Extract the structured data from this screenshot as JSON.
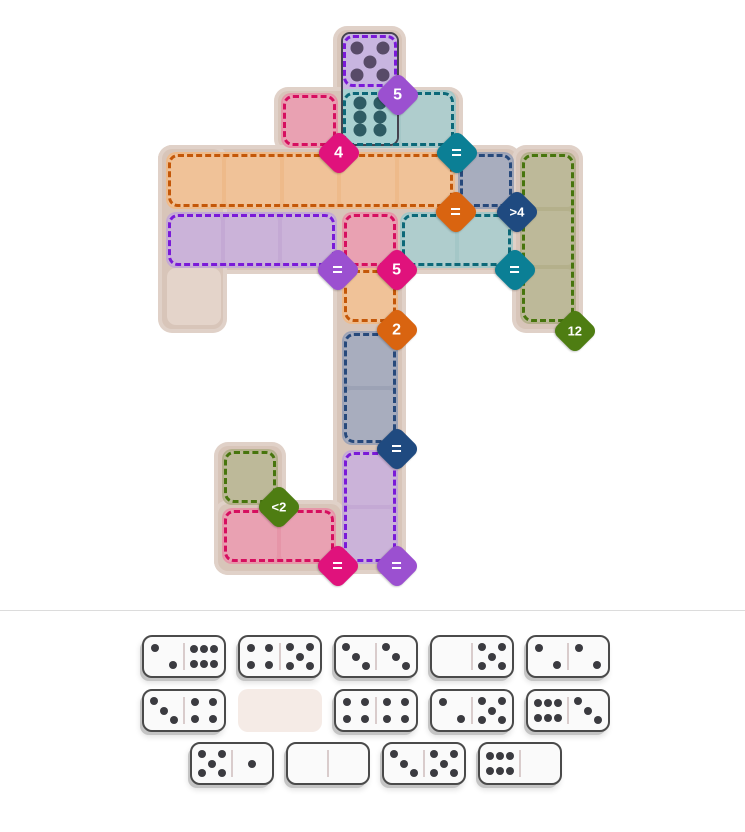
{
  "title": "domino-pips-puzzle",
  "palette": {
    "board_base": "#d8c5b9",
    "empty_cell": "#e4d4ca",
    "separator": "#dcdcdc",
    "regions": {
      "purple": {
        "fill": "#c4a9d4",
        "dash": "#7a1ad8"
      },
      "teal": {
        "fill": "#a4c7c7",
        "dash": "#0c6878"
      },
      "pink": {
        "fill": "#e695a8",
        "dash": "#d60f5f"
      },
      "orange": {
        "fill": "#eeba8a",
        "dash": "#c45708"
      },
      "slate": {
        "fill": "#9ca2b5",
        "dash": "#27497b"
      },
      "olive": {
        "fill": "#b4b08b",
        "dash": "#47750d"
      }
    },
    "badges": {
      "purple": "#9b50d0",
      "magenta": "#e0127c",
      "teal": "#0b7f95",
      "orange": "#d96410",
      "navy": "#1f4a80",
      "green": "#4e7d12"
    },
    "domino": {
      "face": "#fafafa",
      "border": "#4a4a4a",
      "pip": "#3b3b40",
      "divider": "#d9cccc",
      "slot": "#f5ebe6"
    },
    "placed": {
      "top_fill": "#c8b5e0",
      "top_pip": "#584b68",
      "bottom_fill": "#a9d1d1",
      "bottom_pip": "#2e5c64",
      "border": "#45434f"
    }
  },
  "board": {
    "bases": [
      {
        "x": 333,
        "y": 26,
        "w": 73,
        "h": 126
      },
      {
        "x": 274,
        "y": 87,
        "w": 189,
        "h": 66
      },
      {
        "x": 158,
        "y": 145,
        "w": 363,
        "h": 129
      },
      {
        "x": 158,
        "y": 145,
        "w": 69,
        "h": 188
      },
      {
        "x": 512,
        "y": 145,
        "w": 71,
        "h": 188
      },
      {
        "x": 333,
        "y": 262,
        "w": 73,
        "h": 312
      },
      {
        "x": 214,
        "y": 442,
        "w": 72,
        "h": 133
      },
      {
        "x": 214,
        "y": 500,
        "w": 131,
        "h": 75
      }
    ],
    "empty_cells": [
      {
        "x": 167,
        "y": 268,
        "w": 54,
        "h": 57
      }
    ],
    "regions": [
      {
        "id": "top-single",
        "color": "purple",
        "x": 341,
        "y": 33,
        "w": 58,
        "h": 56,
        "cols": 1,
        "rows": 1,
        "badge": {
          "label": "5",
          "color": "purple",
          "cx": 398,
          "cy": 95
        }
      },
      {
        "id": "top-pair",
        "color": "teal",
        "x": 341,
        "y": 90,
        "w": 115,
        "h": 58,
        "cols": 2,
        "rows": 1,
        "badge": {
          "label": "=",
          "color": "teal",
          "cx": 457,
          "cy": 153
        }
      },
      {
        "id": "upper-pink",
        "color": "pink",
        "x": 281,
        "y": 93,
        "w": 57,
        "h": 55,
        "cols": 1,
        "rows": 1,
        "badge": {
          "label": "4",
          "color": "magenta",
          "cx": 339,
          "cy": 153
        }
      },
      {
        "id": "orange-row",
        "color": "orange",
        "x": 166,
        "y": 152,
        "w": 289,
        "h": 57,
        "cols": 5,
        "rows": 1,
        "badge": {
          "label": "=",
          "color": "orange",
          "cx": 456,
          "cy": 212
        }
      },
      {
        "id": "slate-single",
        "color": "slate",
        "x": 458,
        "y": 152,
        "w": 56,
        "h": 57,
        "cols": 1,
        "rows": 1,
        "badge": {
          "label": ">4",
          "color": "navy",
          "cx": 517,
          "cy": 212
        }
      },
      {
        "id": "purple-row",
        "color": "purple",
        "x": 166,
        "y": 212,
        "w": 171,
        "h": 56,
        "cols": 3,
        "rows": 1,
        "badge": {
          "label": "=",
          "color": "purple",
          "cx": 338,
          "cy": 270
        }
      },
      {
        "id": "mid-pink",
        "color": "pink",
        "x": 342,
        "y": 212,
        "w": 56,
        "h": 56,
        "cols": 1,
        "rows": 1,
        "badge": {
          "label": "5",
          "color": "magenta",
          "cx": 397,
          "cy": 270
        }
      },
      {
        "id": "teal-pair",
        "color": "teal",
        "x": 400,
        "y": 212,
        "w": 113,
        "h": 56,
        "cols": 2,
        "rows": 1,
        "badge": {
          "label": "=",
          "color": "teal",
          "cx": 515,
          "cy": 270
        }
      },
      {
        "id": "olive-column",
        "color": "olive",
        "x": 520,
        "y": 152,
        "w": 56,
        "h": 172,
        "cols": 1,
        "rows": 3,
        "badge": {
          "label": "12",
          "color": "green",
          "cx": 575,
          "cy": 331
        }
      },
      {
        "id": "orange-single",
        "color": "orange",
        "x": 342,
        "y": 268,
        "w": 56,
        "h": 56,
        "cols": 1,
        "rows": 1,
        "badge": {
          "label": "2",
          "color": "orange",
          "cx": 397,
          "cy": 330
        }
      },
      {
        "id": "slate-column",
        "color": "slate",
        "x": 342,
        "y": 331,
        "w": 56,
        "h": 114,
        "cols": 1,
        "rows": 2,
        "badge": {
          "label": "=",
          "color": "navy",
          "cx": 397,
          "cy": 449
        }
      },
      {
        "id": "purple-column",
        "color": "purple",
        "x": 342,
        "y": 450,
        "w": 56,
        "h": 114,
        "cols": 1,
        "rows": 2,
        "badge": {
          "label": "=",
          "color": "purple",
          "cx": 397,
          "cy": 566
        }
      },
      {
        "id": "olive-single",
        "color": "olive",
        "x": 222,
        "y": 449,
        "w": 56,
        "h": 56,
        "cols": 1,
        "rows": 1,
        "badge": {
          "label": "<2",
          "color": "green",
          "cx": 279,
          "cy": 507
        }
      },
      {
        "id": "bottom-pink",
        "color": "pink",
        "x": 222,
        "y": 508,
        "w": 114,
        "h": 56,
        "cols": 2,
        "rows": 1,
        "badge": {
          "label": "=",
          "color": "magenta",
          "cx": 338,
          "cy": 566
        }
      }
    ],
    "placed_domino": {
      "x": 341,
      "y": 32,
      "w": 58,
      "h": 114,
      "top_value": 5,
      "bottom_value": 6
    }
  },
  "separator_y": 610,
  "tray": {
    "domino_w": 84,
    "domino_h": 43,
    "pitch": 96,
    "rows": [
      {
        "y": 635,
        "x0": 142,
        "items": [
          [
            2,
            6
          ],
          [
            4,
            5
          ],
          [
            3,
            3
          ],
          [
            0,
            5
          ],
          [
            2,
            2
          ]
        ]
      },
      {
        "y": 689,
        "x0": 142,
        "items": [
          [
            3,
            4
          ],
          null,
          [
            4,
            4
          ],
          [
            2,
            5
          ],
          [
            6,
            3
          ]
        ]
      },
      {
        "y": 742,
        "x0": 190,
        "items": [
          [
            5,
            1
          ],
          [
            0,
            0
          ],
          [
            3,
            5
          ],
          [
            6,
            0
          ]
        ]
      }
    ]
  }
}
